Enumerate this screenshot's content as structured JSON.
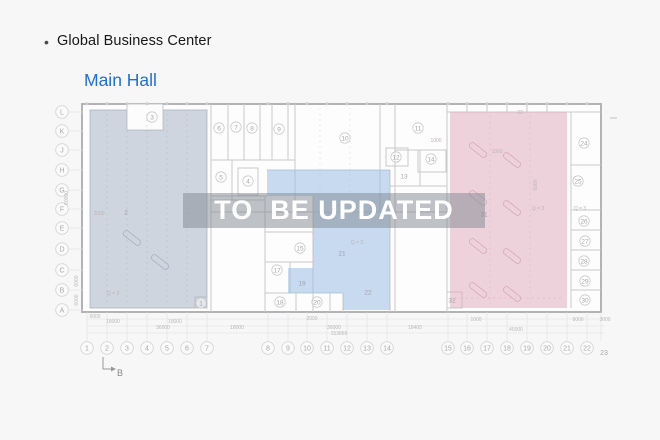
{
  "header": {
    "bullet": "•",
    "title": "Global Business Center"
  },
  "subtitle": {
    "label": "Main Hall"
  },
  "watermark": {
    "text": "TO  BE UPDATED"
  },
  "colors": {
    "title_blue": "#1f6fdb",
    "left_region": "#9fadc0",
    "middle_region": "#9cbde6",
    "right_region": "#dfa8ba",
    "watermark_bg": "rgba(128,136,146,0.5)"
  },
  "floorplan": {
    "axis_bottom": [
      {
        "label": "1",
        "x": 87
      },
      {
        "label": "2",
        "x": 107
      },
      {
        "label": "3",
        "x": 127
      },
      {
        "label": "4",
        "x": 147
      },
      {
        "label": "5",
        "x": 167
      },
      {
        "label": "6",
        "x": 187
      },
      {
        "label": "7",
        "x": 207
      },
      {
        "label": "8",
        "x": 268
      },
      {
        "label": "9",
        "x": 288
      },
      {
        "label": "10",
        "x": 307
      },
      {
        "label": "11",
        "x": 327
      },
      {
        "label": "12",
        "x": 347
      },
      {
        "label": "13",
        "x": 367
      },
      {
        "label": "14",
        "x": 387
      },
      {
        "label": "15",
        "x": 448
      },
      {
        "label": "16",
        "x": 467
      },
      {
        "label": "17",
        "x": 487
      },
      {
        "label": "18",
        "x": 507
      },
      {
        "label": "19",
        "x": 527
      },
      {
        "label": "20",
        "x": 547
      },
      {
        "label": "21",
        "x": 567
      },
      {
        "label": "22",
        "x": 587
      }
    ],
    "axis_bottom_end": {
      "label": "23",
      "x": 604,
      "y": 355
    },
    "axis_left": [
      {
        "label": "L",
        "y": 112
      },
      {
        "label": "K",
        "y": 131
      },
      {
        "label": "J",
        "y": 150
      },
      {
        "label": "H",
        "y": 170
      },
      {
        "label": "G",
        "y": 190
      },
      {
        "label": "F",
        "y": 209
      },
      {
        "label": "E",
        "y": 228
      },
      {
        "label": "D",
        "y": 249
      },
      {
        "label": "C",
        "y": 270
      },
      {
        "label": "B",
        "y": 290
      },
      {
        "label": "A",
        "y": 310
      }
    ],
    "rooms": [
      {
        "label": "1",
        "x": 201,
        "y": 303,
        "circled": true
      },
      {
        "label": "2",
        "x": 126,
        "y": 212,
        "circled": false
      },
      {
        "label": "3",
        "x": 152,
        "y": 117,
        "circled": true
      },
      {
        "label": "4",
        "x": 248,
        "y": 181,
        "circled": true
      },
      {
        "label": "5",
        "x": 221,
        "y": 177,
        "circled": true
      },
      {
        "label": "6",
        "x": 219,
        "y": 128,
        "circled": true
      },
      {
        "label": "7",
        "x": 236,
        "y": 127,
        "circled": true
      },
      {
        "label": "8",
        "x": 252,
        "y": 128,
        "circled": true
      },
      {
        "label": "9",
        "x": 279,
        "y": 129,
        "circled": true
      },
      {
        "label": "10",
        "x": 345,
        "y": 138,
        "circled": true
      },
      {
        "label": "11",
        "x": 418,
        "y": 128,
        "circled": true
      },
      {
        "label": "12",
        "x": 396,
        "y": 157,
        "circled": true
      },
      {
        "label": "13",
        "x": 404,
        "y": 176,
        "circled": false
      },
      {
        "label": "14",
        "x": 431,
        "y": 159,
        "circled": true
      },
      {
        "label": "15",
        "x": 300,
        "y": 248,
        "circled": true
      },
      {
        "label": "17",
        "x": 277,
        "y": 270,
        "circled": true
      },
      {
        "label": "18",
        "x": 280,
        "y": 302,
        "circled": true
      },
      {
        "label": "19",
        "x": 302,
        "y": 283,
        "circled": false
      },
      {
        "label": "20",
        "x": 317,
        "y": 302,
        "circled": true
      },
      {
        "label": "21",
        "x": 342,
        "y": 253,
        "circled": false
      },
      {
        "label": "22",
        "x": 368,
        "y": 292,
        "circled": false
      },
      {
        "label": "24",
        "x": 584,
        "y": 143,
        "circled": true
      },
      {
        "label": "25",
        "x": 578,
        "y": 181,
        "circled": true
      },
      {
        "label": "26",
        "x": 584,
        "y": 221,
        "circled": true
      },
      {
        "label": "27",
        "x": 585,
        "y": 241,
        "circled": true
      },
      {
        "label": "28",
        "x": 584,
        "y": 261,
        "circled": true
      },
      {
        "label": "29",
        "x": 585,
        "y": 281,
        "circled": true
      },
      {
        "label": "30",
        "x": 585,
        "y": 300,
        "circled": true
      },
      {
        "label": "31",
        "x": 484,
        "y": 214,
        "circled": false
      },
      {
        "label": "32",
        "x": 452,
        "y": 300,
        "circled": false
      }
    ],
    "dims": [
      {
        "text": "6000",
        "x": 95,
        "y": 318
      },
      {
        "text": "18000",
        "x": 113,
        "y": 323
      },
      {
        "text": "18000",
        "x": 175,
        "y": 323
      },
      {
        "text": "36000",
        "x": 163,
        "y": 329
      },
      {
        "text": "18000",
        "x": 237,
        "y": 329
      },
      {
        "text": "2000",
        "x": 312,
        "y": 320
      },
      {
        "text": "36000",
        "x": 334,
        "y": 329
      },
      {
        "text": "153669",
        "x": 339,
        "y": 335
      },
      {
        "text": "18400",
        "x": 415,
        "y": 329
      },
      {
        "text": "1000",
        "x": 476,
        "y": 321
      },
      {
        "text": "45000",
        "x": 516,
        "y": 331
      },
      {
        "text": "6000",
        "x": 578,
        "y": 321
      },
      {
        "text": "3000",
        "x": 605,
        "y": 321
      }
    ],
    "vdims": [
      {
        "text": "60000",
        "x": 68,
        "y": 198
      },
      {
        "text": "6000",
        "x": 78,
        "y": 281
      },
      {
        "text": "6000",
        "x": 78,
        "y": 300
      },
      {
        "text": "6000",
        "x": 537,
        "y": 185
      }
    ],
    "notes": [
      {
        "text": "Q = 3",
        "x": 113,
        "y": 295
      },
      {
        "text": "Q = 3",
        "x": 357,
        "y": 244
      },
      {
        "text": "Q = 3",
        "x": 538,
        "y": 210
      },
      {
        "text": "Q = 3",
        "x": 580,
        "y": 210
      },
      {
        "text": "23",
        "x": 520,
        "y": 114
      },
      {
        "text": "1000",
        "x": 436,
        "y": 142
      },
      {
        "text": "1000",
        "x": 497,
        "y": 153
      },
      {
        "text": "2000",
        "x": 99,
        "y": 215
      }
    ],
    "section_marker": {
      "label": "B"
    }
  }
}
